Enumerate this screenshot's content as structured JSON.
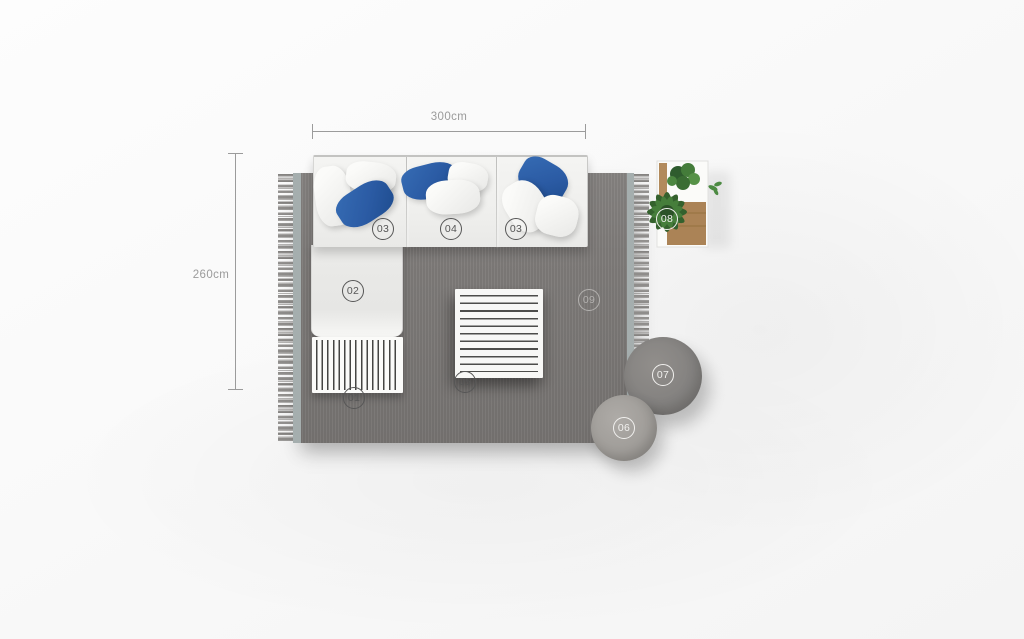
{
  "dimensions": {
    "width_label": "300cm",
    "height_label": "260cm"
  },
  "badges": {
    "b01": {
      "label": "01"
    },
    "b02": {
      "label": "02"
    },
    "b03_left": {
      "label": "03"
    },
    "b04": {
      "label": "04"
    },
    "b03_right": {
      "label": "03"
    },
    "b05": {
      "label": "05"
    },
    "b06": {
      "label": "06"
    },
    "b07": {
      "label": "07"
    },
    "b08": {
      "label": "08"
    },
    "b09": {
      "label": "09"
    }
  },
  "colors": {
    "rug": "#7d7a78",
    "rug_selvage": "#a5aeae",
    "accent_pillow_blue": "#2b5ba4",
    "sofa_fabric": "#f1f1ef",
    "pouf_large": "#848280",
    "pouf_small": "#a09d99",
    "plant_green": "#447a3a",
    "wood": "#b0885c",
    "badge_dark": "#565656",
    "badge_light": "#f1f0ee",
    "badge_muted": "#b3b1af",
    "dimension": "#9b9b9b"
  }
}
